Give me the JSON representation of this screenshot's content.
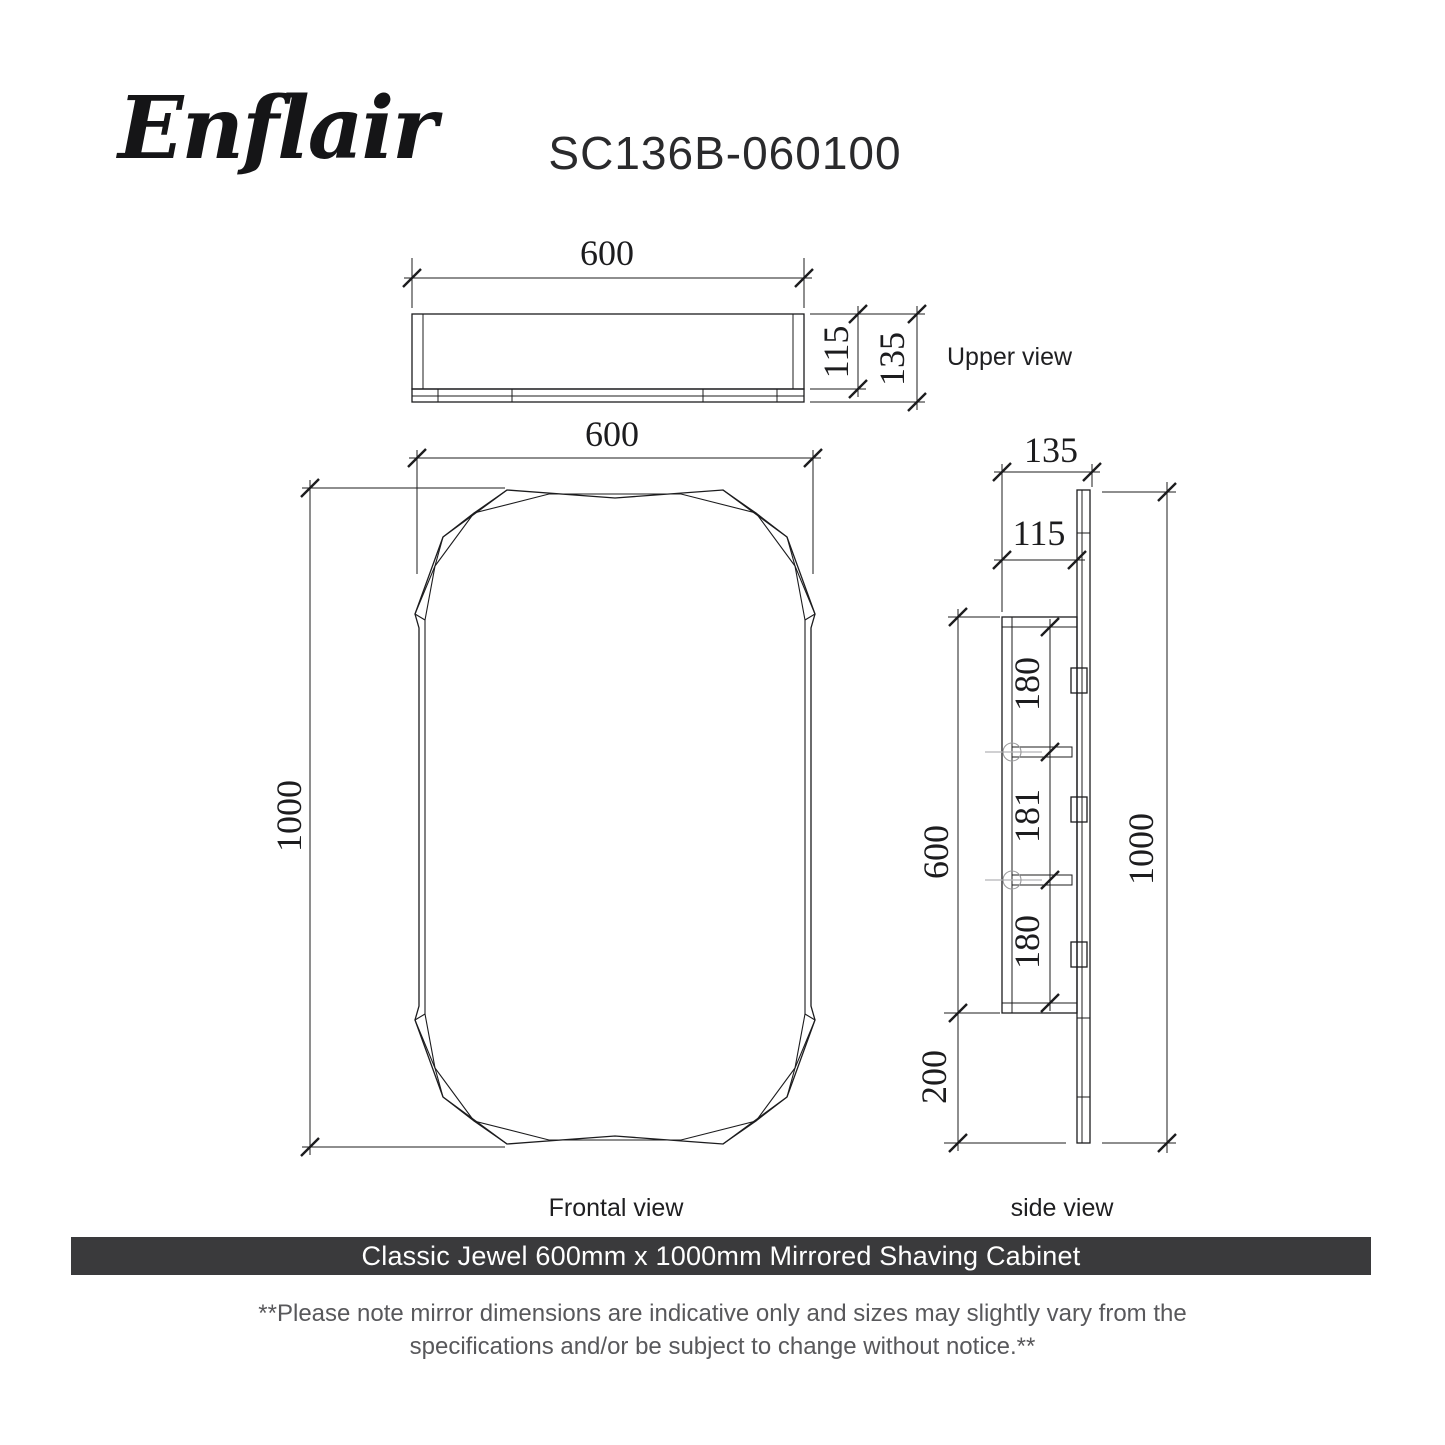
{
  "header": {
    "logo_text": "Enflair",
    "model_number": "SC136B-060100"
  },
  "views": {
    "upper": {
      "label": "Upper view",
      "width_mm": "600",
      "body_depth_mm": "115",
      "total_depth_mm": "135"
    },
    "frontal": {
      "label": "Frontal view",
      "width_mm": "600",
      "height_mm": "1000"
    },
    "side": {
      "label": "side view",
      "total_depth_mm": "135",
      "body_depth_mm": "115",
      "shelf_spacing_mm": [
        "180",
        "181",
        "180"
      ],
      "body_height_mm": "600",
      "bottom_offset_mm": "200",
      "total_height_mm": "1000"
    }
  },
  "banner": {
    "text": "Classic Jewel 600mm x 1000mm Mirrored Shaving Cabinet",
    "background_color": "#3a3a3c",
    "text_color": "#ffffff"
  },
  "note": {
    "line1": "**Please note mirror dimensions are indicative only and sizes may slightly vary from the",
    "line2": "specifications and/or be subject to change without notice.**"
  },
  "drawing": {
    "line_color": "#1c1c1e"
  }
}
